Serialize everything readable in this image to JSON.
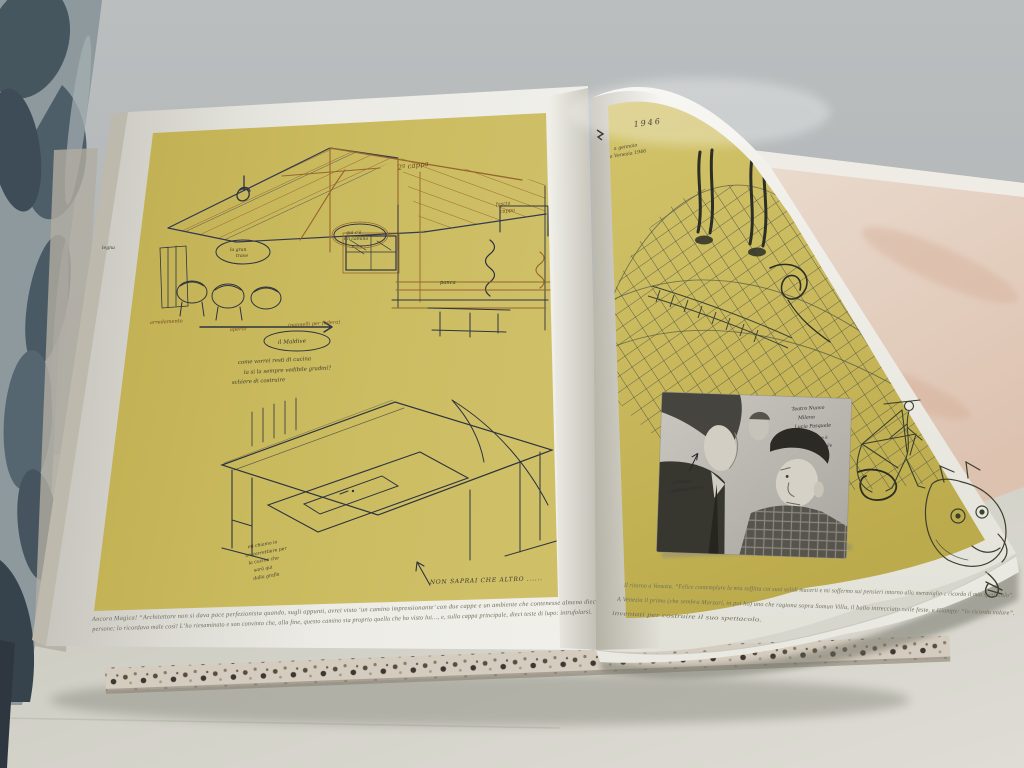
{
  "scene_type": "photograph of an open art book of architectural and theatre sketches on a table, curtain at left, page being turned on the right",
  "colors": {
    "wall": "#b5b9bb",
    "table": "#d6d5cc",
    "page_white": "#edece6",
    "sketch_panel_olive": "#c9b95c",
    "underlying_page_pink": "#e6d2c4",
    "ink_brown": "#96662e",
    "ink_dark_blue": "#333a52",
    "pencil_gray": "#565a49",
    "curtain_slate": "#4c5c68",
    "photo_gray": "#b8b5ae"
  },
  "left_page": {
    "caption_line1": "Ancora Magica! “Architettore non si dava pace perfezionista quando, sugli appunti, avrei visto ‘un camino impressionante’ con due cappe e un ambiente che contenesse almeno dieci",
    "caption_line2": "persone; lo ricordava male così! L’ho riesaminato e son convinto che, alla fine, questo camino sia proprio quello che ho visto lui…, e, sulla cappa principale, dieci teste di lupo: intrufolarsi.",
    "notes": {
      "cappa2": "2ª cappa",
      "fascia": "fascia",
      "cappa": "cappa",
      "bubble_center_a": "qui c'è",
      "bubble_center_b": "un camino",
      "bubble_mid_a": "la gran",
      "bubble_mid_b": "trave",
      "bubble_left": "legna",
      "panca": "panca",
      "arredamento": "arredamento",
      "aperto": "aperto",
      "pannelli": "(pannelli per fodera)",
      "maldive": "il Maldive",
      "desk_q1": "come vorrei resti di cucina",
      "desk_q2": "la si la sempre vedibile gradini?",
      "desk_q3": "schiere di costruire",
      "side_1": "mi chiamo io",
      "side_2": "un carrettiere per",
      "side_3": "la cucina che",
      "side_4": "sarà qui",
      "side_5": "dalla grafia",
      "footer": "NON SAPRAI CHE ALTRO ......"
    }
  },
  "right_page": {
    "year_note": "1946",
    "inscription_line1": "a gennaio",
    "inscription_line2": "a Venezia 1946",
    "photo_notes_right": [
      "Teatro Nuovo",
      "Milano",
      "Lucia Pasquale",
      "vedi se è",
      "possibile"
    ],
    "photo_note_left_1": "il Felice",
    "photo_note_left_2": "Contemplatore",
    "caption_line1": "Il ritorno a Venezia. “Felice contemplare la mia soffitta coi suoi solidi macerii e mi soffermo sui pensieri intorno alla meraviglia e ricordo il mio spettacolo”.",
    "caption_line2": "A Venezia il primo (che sembra Marzari, in poi ho) uno che ragiona sopra Somun Villa, il ballo intrecciato nelle feste, e Giampy: “lo ricordo volare”.",
    "caption_line3": "inventati per costruire il suo spettacolo."
  }
}
